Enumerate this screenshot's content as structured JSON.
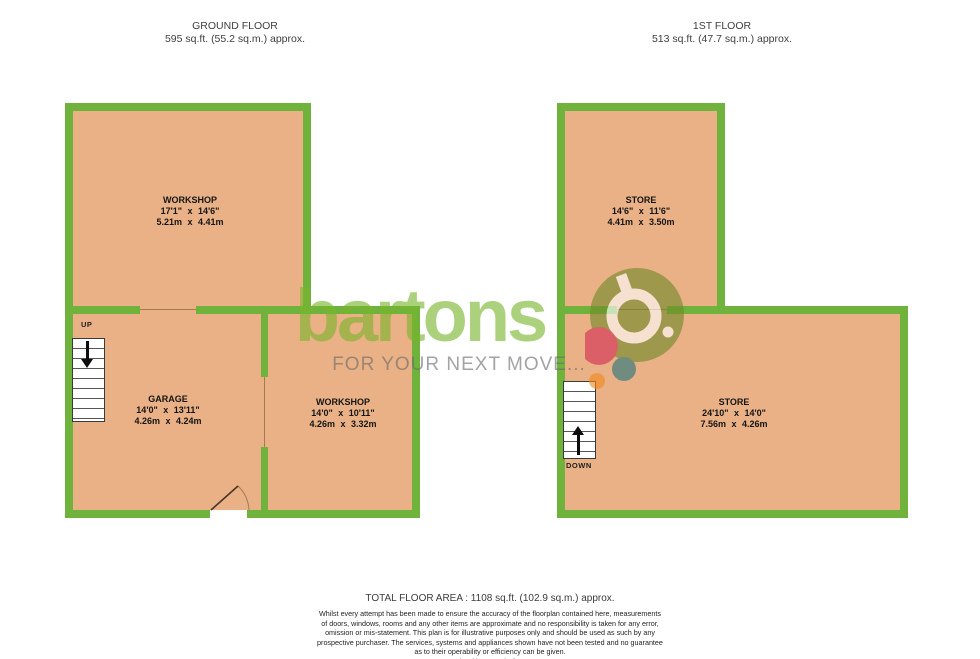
{
  "floors": {
    "ground": {
      "title": "GROUND FLOOR",
      "area": "595 sq.ft. (55.2 sq.m.) approx.",
      "rooms": [
        {
          "name": "WORKSHOP",
          "imperial": "17'1\" x 14'6\"",
          "metric": "5.21m x 4.41m"
        },
        {
          "name": "GARAGE",
          "imperial": "14'0\" x 13'11\"",
          "metric": "4.26m x 4.24m"
        },
        {
          "name": "WORKSHOP",
          "imperial": "14'0\" x 10'11\"",
          "metric": "4.26m x 3.32m"
        }
      ],
      "stair_label": "UP"
    },
    "first": {
      "title": "1ST FLOOR",
      "area": "513 sq.ft. (47.7 sq.m.) approx.",
      "rooms": [
        {
          "name": "STORE",
          "imperial": "14'6\" x 11'6\"",
          "metric": "4.41m x 3.50m"
        },
        {
          "name": "STORE",
          "imperial": "24'10\" x 14'0\"",
          "metric": "7.56m x 4.26m"
        }
      ],
      "stair_label": "DOWN"
    }
  },
  "watermark": {
    "brand": "bartons",
    "tagline": "FOR YOUR NEXT MOVE..."
  },
  "footer": {
    "total": "TOTAL FLOOR AREA : 1108 sq.ft. (102.9 sq.m.) approx.",
    "disclaimer_lines": [
      "Whilst every attempt has been made to ensure the accuracy of the floorplan contained here, measurements",
      "of doors, windows, rooms and any other items are approximate and no responsibility is taken for any error,",
      "omission or mis-statement. This plan is for illustrative purposes only and should be used as such by any",
      "prospective purchaser. The services, systems and appliances shown have not been tested and no guarantee",
      "as to their operability or efficiency can be given.",
      "Made with Metropix ©2025"
    ]
  },
  "colors": {
    "wall_green": "#6fb33c",
    "room_fill": "#e9b185",
    "brand_green": "#7ab52e",
    "tagline_gray": "#6b6b6b",
    "logo_olive": "#6f8a28",
    "logo_pink": "#d42e55",
    "logo_teal": "#27777f",
    "logo_orange": "#f28a1f"
  }
}
